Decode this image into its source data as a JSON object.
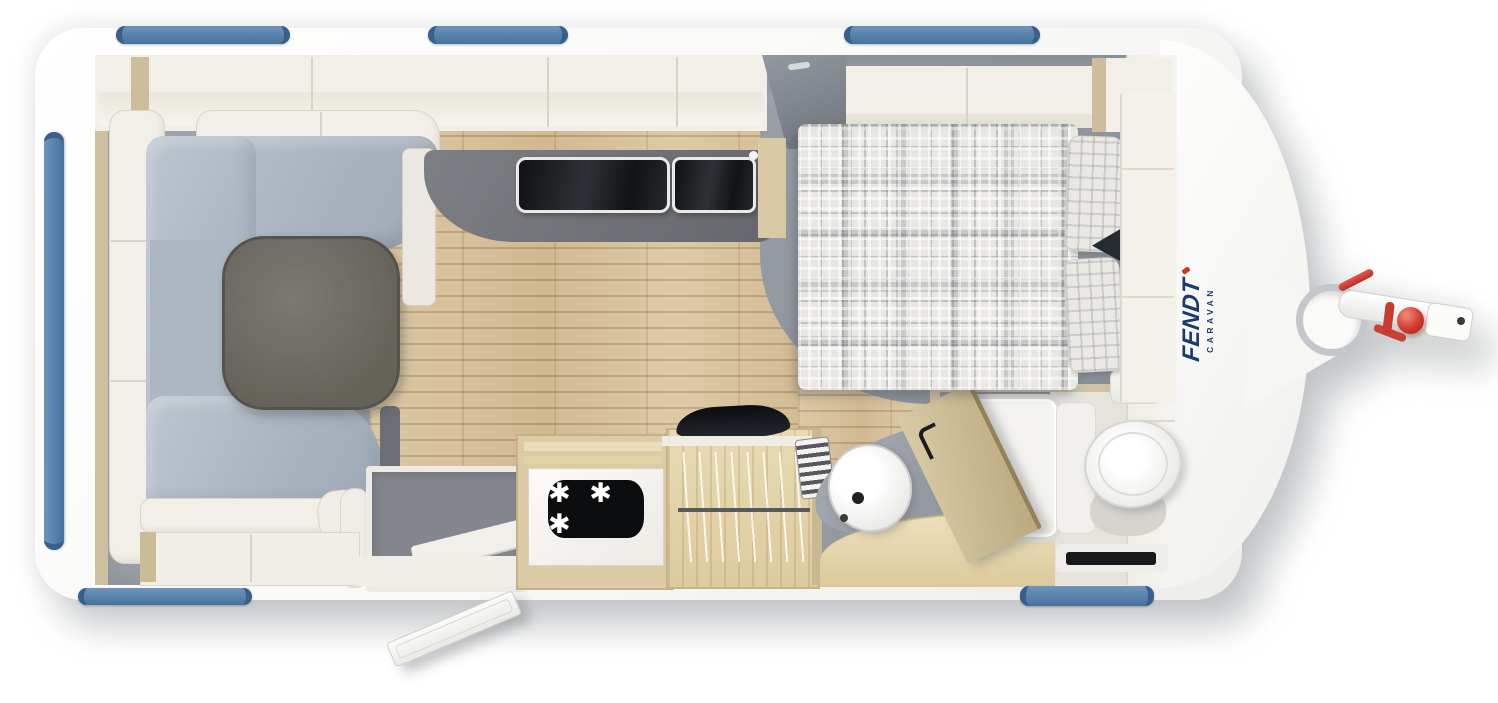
{
  "title": "Fendt caravan floor plan",
  "brand": {
    "primary": "FENDT",
    "secondary": "CARAVAN",
    "logo_color": "#1d3a6f",
    "accent_red": "#c8372c"
  },
  "appliances": {
    "freezer_rating_symbol": "✱ ✱ ✱"
  },
  "colors": {
    "body_white": "#f7f7f5",
    "window_blue": "#4d7aa6",
    "upholstery_gray_blue": "#aeb8c4",
    "table_top": "#6b6962",
    "kitchen_worktop": "#6e7075",
    "wood_floor": "#d8c29a",
    "cabinet_wood": "#dccba5",
    "platform_gray": "#8f959c",
    "hitch_red": "#c8372c"
  },
  "components": {
    "lounge": [
      "u-shaped-sofa",
      "dinette-table",
      "overhead-lockers"
    ],
    "kitchen": [
      "worktop",
      "sink-glass-lid",
      "hob-glass-lid",
      "refrigerator",
      "freezer-compartment"
    ],
    "middle": [
      "entrance-door",
      "entry-step",
      "wardrobe-with-hangers",
      "tv",
      "heater"
    ],
    "bathroom": [
      "washbasin",
      "vanity-cabinet",
      "shower-tray",
      "shower-door",
      "toilet",
      "water-heater",
      "floor-vent"
    ],
    "bedroom": [
      "french-bed",
      "pillow-left",
      "pillow-right",
      "overhead-lockers"
    ],
    "exterior": [
      "windows",
      "drawbar",
      "hitch-coupling",
      "jockey-wheel-crank",
      "handbrake-lever"
    ]
  }
}
